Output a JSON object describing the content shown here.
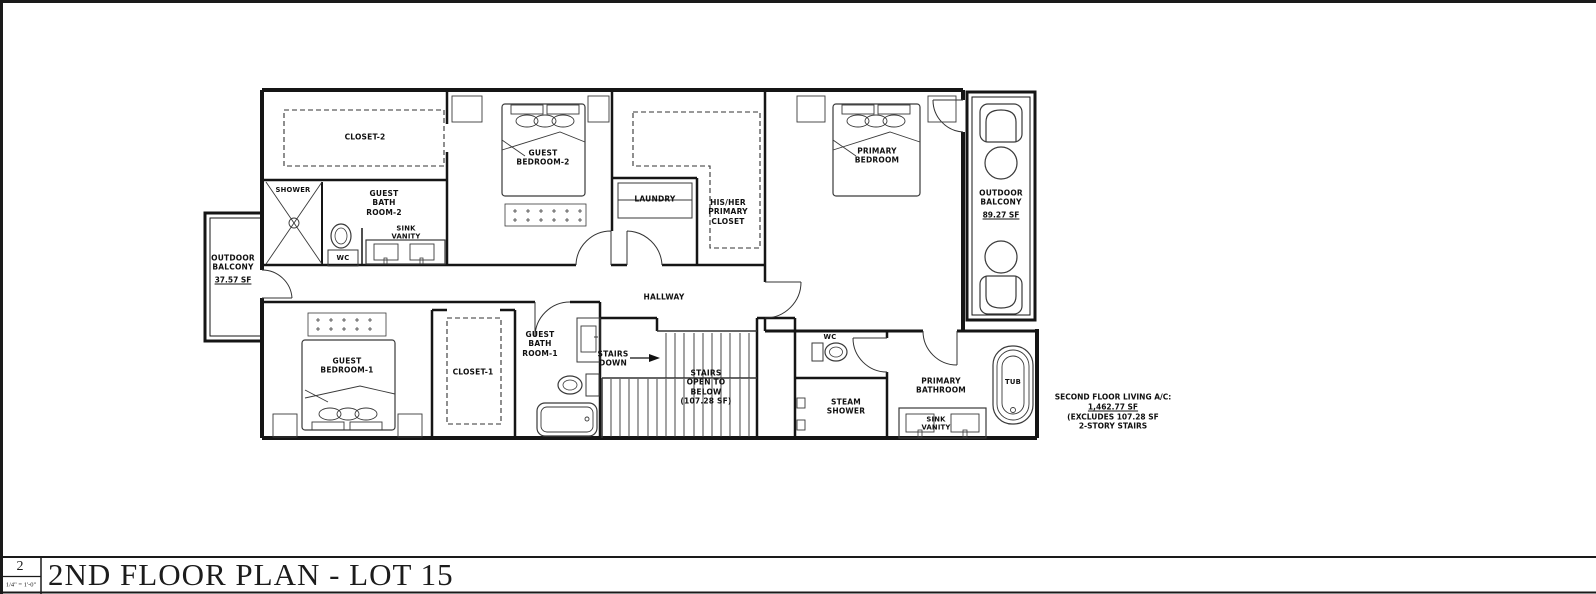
{
  "page": {
    "title": "2ND FLOOR PLAN - LOT 15",
    "sheet_number": "2",
    "scale": "1/4\" = 1'-0\""
  },
  "rooms": {
    "closet2": "CLOSET-2",
    "shower": "SHOWER",
    "guest_bath_2": "GUEST\nBATH\nROOM-2",
    "wc_2": "WC",
    "sink_vanity_2": "SINK\nVANITY",
    "guest_bedroom_2": "GUEST\nBEDROOM-2",
    "laundry": "LAUNDRY",
    "his_her_primary_closet": "HIS/HER\nPRIMARY\nCLOSET",
    "primary_bedroom": "PRIMARY\nBEDROOM",
    "outdoor_balcony_right": "OUTDOOR\nBALCONY",
    "outdoor_balcony_right_area": "89.27 SF",
    "outdoor_balcony_left": "OUTDOOR\nBALCONY",
    "outdoor_balcony_left_area": "37.57 SF",
    "hallway": "HALLWAY",
    "guest_bedroom_1": "GUEST\nBEDROOM-1",
    "closet_1": "CLOSET-1",
    "guest_bath_1": "GUEST\nBATH\nROOM-1",
    "stairs_down": "STAIRS\nDOWN",
    "stairs_open_below": "STAIRS\nOPEN TO\nBELOW\n(107.28 SF)",
    "wc_main": "WC",
    "steam_shower": "STEAM\nSHOWER",
    "primary_bathroom": "PRIMARY\nBATHROOM",
    "sink_vanity_primary": "SINK\nVANITY",
    "tub": "TUB"
  },
  "annotation": {
    "line1": "SECOND FLOOR LIVING A/C:",
    "line2": "1,462.77 SF",
    "line3": "(EXCLUDES 107.28 SF",
    "line4": "2-STORY STAIRS"
  },
  "colors": {
    "line": "#1a1a1a",
    "background": "#ffffff"
  }
}
